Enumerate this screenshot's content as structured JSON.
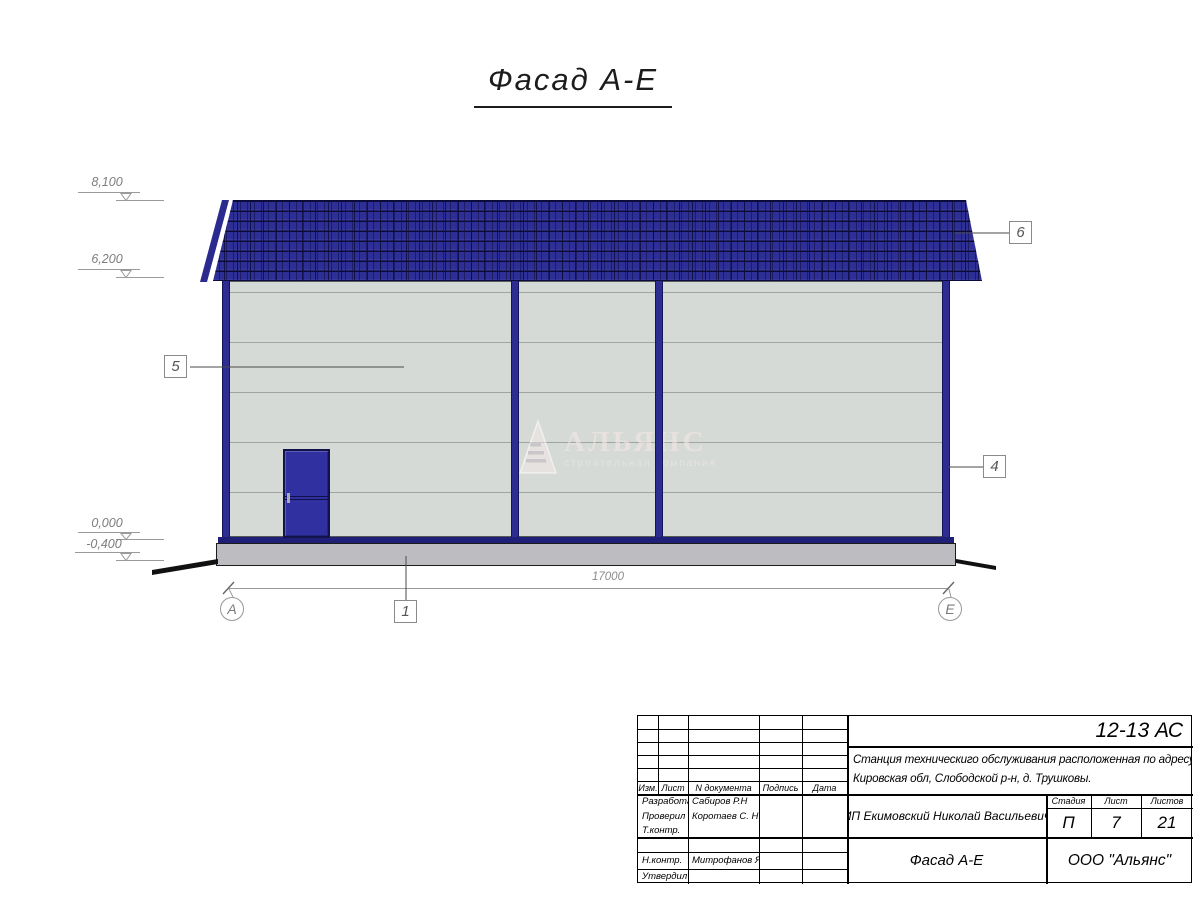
{
  "drawing_title": "Фасад А-Е",
  "drawing": {
    "elevations": [
      "8,100",
      "6,200",
      "0,000",
      "-0,400"
    ],
    "dimension_total": "17000",
    "axis_left": "А",
    "axis_right": "Е",
    "callouts": {
      "wall_panel": "5",
      "roof": "6",
      "corner": "4",
      "foundation": "1"
    },
    "watermark": {
      "title": "АЛЬЯНС",
      "subtitle": "строительная компания"
    },
    "colors": {
      "roof_navy": "#2e2e97",
      "trim_navy": "#2c2c93",
      "wall_gray": "#d6dad6",
      "foundation_gray": "#bdbdc1"
    }
  },
  "title_block": {
    "document_code": "12-13 АС",
    "project_description_line1": "Станция техническиго обслуживания расположенная по адресу",
    "project_description_line2": "Кировская обл, Слободской р-н, д. Трушковы.",
    "client": "ИП Екимовский Николай Васильевич",
    "sheet_name": "Фасад А-Е",
    "company": "ООО \"Альянс\"",
    "columns": {
      "izm": "Изм.",
      "list": "Лист",
      "doc_num": "N документа",
      "signature": "Подпись",
      "date": "Дата"
    },
    "staff": [
      {
        "role": "Разработал",
        "name": "Сабиров Р.Н"
      },
      {
        "role": "Проверил",
        "name": "Коротаев С. Н"
      },
      {
        "role": "Т.контр.",
        "name": ""
      },
      {
        "role": "",
        "name": ""
      },
      {
        "role": "Н.контр.",
        "name": "Митрофанов Я. А"
      },
      {
        "role": "Утвердил",
        "name": ""
      }
    ],
    "stage_label": "Стадия",
    "stage_value": "П",
    "sheet_label": "Лист",
    "sheet_value": "7",
    "sheets_label": "Листов",
    "sheets_value": "21"
  }
}
